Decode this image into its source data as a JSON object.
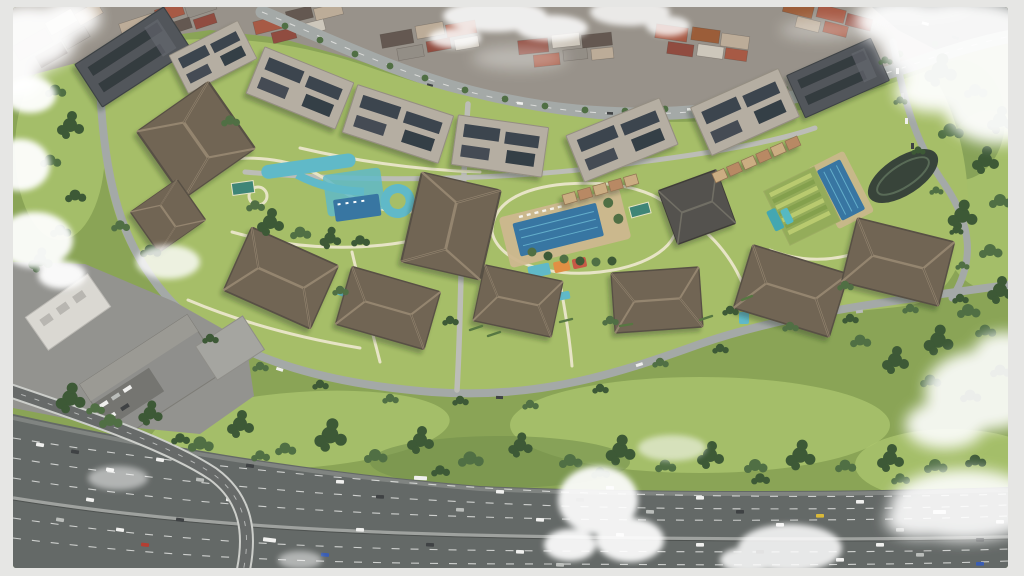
{
  "scene": {
    "type": "aerial-architectural-render",
    "description": "Top-down aerial 3D rendering of a large residential complex with landscaped courtyards, swimming pools, a waterpark and garden allotments, bordered above by a curving city street with dense urban blocks, below by a tree-dotted park, and a busy multi-lane highway with an overpass ramp crossing the bottom; scattered white clouds partially cover the view.",
    "features": [
      "residential-complex",
      "apartment-buildings",
      "hip-roofs",
      "solar-panel-roofs",
      "central-swimming-pool",
      "waterpark",
      "kids-pools",
      "garden-allotments",
      "sports-court",
      "urban-blocks",
      "city-street",
      "perimeter-boulevard",
      "park-trees",
      "forest",
      "industrial-buildings",
      "highway-traffic",
      "overpass-ramp",
      "clouds"
    ]
  },
  "palette": {
    "frame": "#e6e6e4",
    "park_grass": "#84a04d",
    "lawn": "#a2bb60",
    "grass_light": "#aac468",
    "urban_base": "#938d84",
    "tree_dark": "#33512c",
    "tree_mid": "#47683a",
    "roof_hip": "#6a5d4c",
    "roof_ridge": "#93836c",
    "roof_flat": "#b2aa9d",
    "solar_panel": "#333b45",
    "roof_dark_slab": "#4a4e52",
    "urban_terracotta": "#a3523c",
    "urban_tan": "#b9a893",
    "road_urban": "#a0a5a3",
    "road_light": "#b9bab4",
    "path_cream": "#e6e3c3",
    "pool_deep": "#2e6f9e",
    "pool_teal": "#58b6c6",
    "deck_tan": "#cbb489",
    "highway_asphalt": "#5c615f",
    "lane_marking": "#e9eae7",
    "median_gray": "#9a9d9a",
    "industrial_roof": "#8a8a86",
    "building_white": "#d8d6d0",
    "ramp_edge": "#caccc8",
    "cloud_white": "#ffffff"
  }
}
